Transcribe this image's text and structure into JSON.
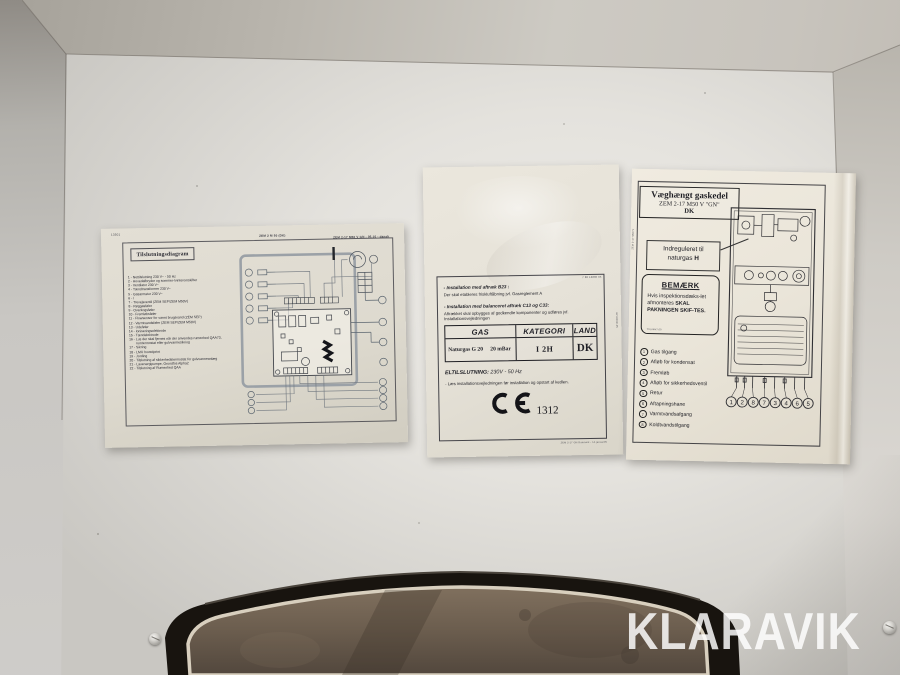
{
  "photo": {
    "watermark": "KLARAVIK"
  },
  "left_label": {
    "micro_header_left": "13501",
    "micro_header_center": "ZEM 2 M 50 (DK)",
    "micro_header_right": "ZEM 2-17 M50 V GN - 05.10 - dansk",
    "title": "Tilslutningsdiagram",
    "legend": [
      "1 - Nettilslutning 230 V~ - 50 Hz",
      "2 - Hovedafbryder og sommer-/vinteromskifter",
      "3 - Ventilator 230 V~",
      "4 - Tændtransformer 230 V~",
      "5 - Gasarmatur 230 V~",
      "6 - /",
      "7 - Trevejsventil (ZEM SEP/ZEM M50V)",
      "8 - Røggasføler",
      "9 - Overkogsføler",
      "10 - Fremløbsføler",
      "11 - Flowsensor for varmt brugsvand (ZEM SEP)",
      "12 - Varmtvandsføler (ZEM SEP/ZEM M50V)",
      "13 - Udeføler",
      "14 - Ioniseringselektrode",
      "15 - Tændelektrode",
      "16 - Lus der skal fjernes når der anvendes rumenhed QAA73, rumtermostat eller gulvvarmesikring",
      "17 - Sikring",
      "18 - LMU hovedprint",
      "19 - Jording",
      "20 - Tilslutning af sikkerhedstermostat for gulvvarmeanlæg",
      "21 - Lavenergipumpe, Grundfos Alpha2",
      "22 - Tilslutning af Rumenhed QAA"
    ]
  },
  "middle_label": {
    "micro_top_right": "7 86 12800 05",
    "section_b23": {
      "heading": "- Installation med aftræk B23 :",
      "body": "Der skal etableres friskluftåbning jvf. Gasreglement A"
    },
    "section_c13": {
      "heading": "- Installation med balanceret aftræk C13 og C33:",
      "body": "Aftrækket skal opbygges af godkendte komponenter og udføres jvf. Installationsvejledningen"
    },
    "table": {
      "col_gas": "GAS",
      "col_kategori": "KATEGORI",
      "col_land": "LAND",
      "gas_value": "Naturgas G 20",
      "pressure_value": "20 mBar",
      "kategori_value": "I 2H",
      "land_value": "DK"
    },
    "el_label": "ELTILSLUTNING:",
    "el_value": "230V - 50 Hz",
    "note": "- Læs installationsvejledningen før installation og opstart af kedlen.",
    "ce_number": "1312",
    "micro_bottom": "ZEM 2-17 GN Danmark - 14.januar05",
    "micro_side": "8719002135"
  },
  "right_label": {
    "title_line1": "Væghængt gaskedel",
    "title_line2": "ZEM 2-17 M50 V \"GN\"",
    "title_line3": "DK",
    "callout_line1": "Indreguleret til",
    "callout_line2_pre": "naturgas ",
    "callout_line2_bold": "H",
    "note_title": "BEMÆRK",
    "note_body_regular": "Hvis inspektionsdæks-let afmonteres ",
    "note_body_bold": "SKAL PAKNINGEN SKIF-TES.",
    "note_micro": "TXU/M47.00",
    "micro_side": "ZEM 2-17 M50 V",
    "legend": [
      {
        "num": "1",
        "label": "Gas tilgang"
      },
      {
        "num": "2",
        "label": "Afløb for kondensat"
      },
      {
        "num": "3",
        "label": "Fremløb"
      },
      {
        "num": "4",
        "label": "Afløb for sikkerhedsventil"
      },
      {
        "num": "5",
        "label": "Retur"
      },
      {
        "num": "6",
        "label": "Aftapningshane"
      },
      {
        "num": "7",
        "label": "Varmtvandsafgang"
      },
      {
        "num": "8",
        "label": "Koldtvandstilgang"
      }
    ],
    "bottom_numbers": [
      "1",
      "2",
      "8",
      "7",
      "3",
      "4",
      "6",
      "5"
    ]
  }
}
